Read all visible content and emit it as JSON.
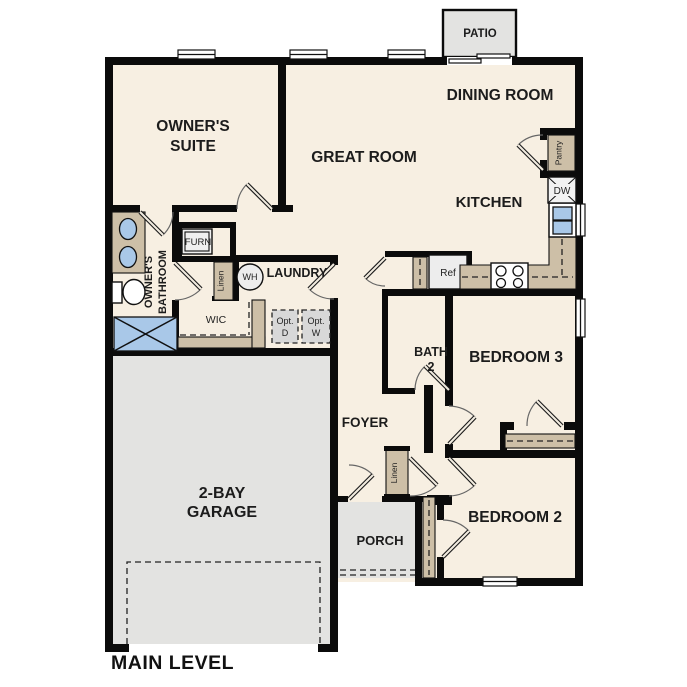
{
  "plan": {
    "title": "MAIN LEVEL",
    "rooms": {
      "patio": "PATIO",
      "dining_room": "DINING ROOM",
      "great_room": "GREAT ROOM",
      "kitchen": "KITCHEN",
      "owners_suite": [
        "OWNER'S",
        "SUITE"
      ],
      "owners_bathroom": [
        "OWNER'S",
        "BATHROOM"
      ],
      "laundry": "LAUNDRY",
      "wic": "WIC",
      "foyer": "FOYER",
      "bath2": [
        "BATH",
        "2"
      ],
      "bedroom3": "BEDROOM 3",
      "bedroom2": "BEDROOM 2",
      "garage": [
        "2-BAY",
        "GARAGE"
      ],
      "porch": "PORCH"
    },
    "fixtures": {
      "furnace": "FURN",
      "water_heater": "WH",
      "linen_laundry": "Linen",
      "linen_foyer": "Linen",
      "opt_dryer": [
        "Opt.",
        "D"
      ],
      "opt_washer": [
        "Opt.",
        "W"
      ],
      "pantry": "Pantry",
      "dishwasher": "DW",
      "refrigerator": "Ref"
    },
    "colors": {
      "floor": "#f7efe2",
      "outdoor": "#e3e3e1",
      "wall": "#0b0b0b",
      "cabinet": "#cdbfa7",
      "fixture_blue": "#a9c8e8",
      "appliance": "#ededed",
      "opt_box": "#d8d8d8",
      "text": "#1c1c1c",
      "door_arc": "#666666"
    }
  }
}
